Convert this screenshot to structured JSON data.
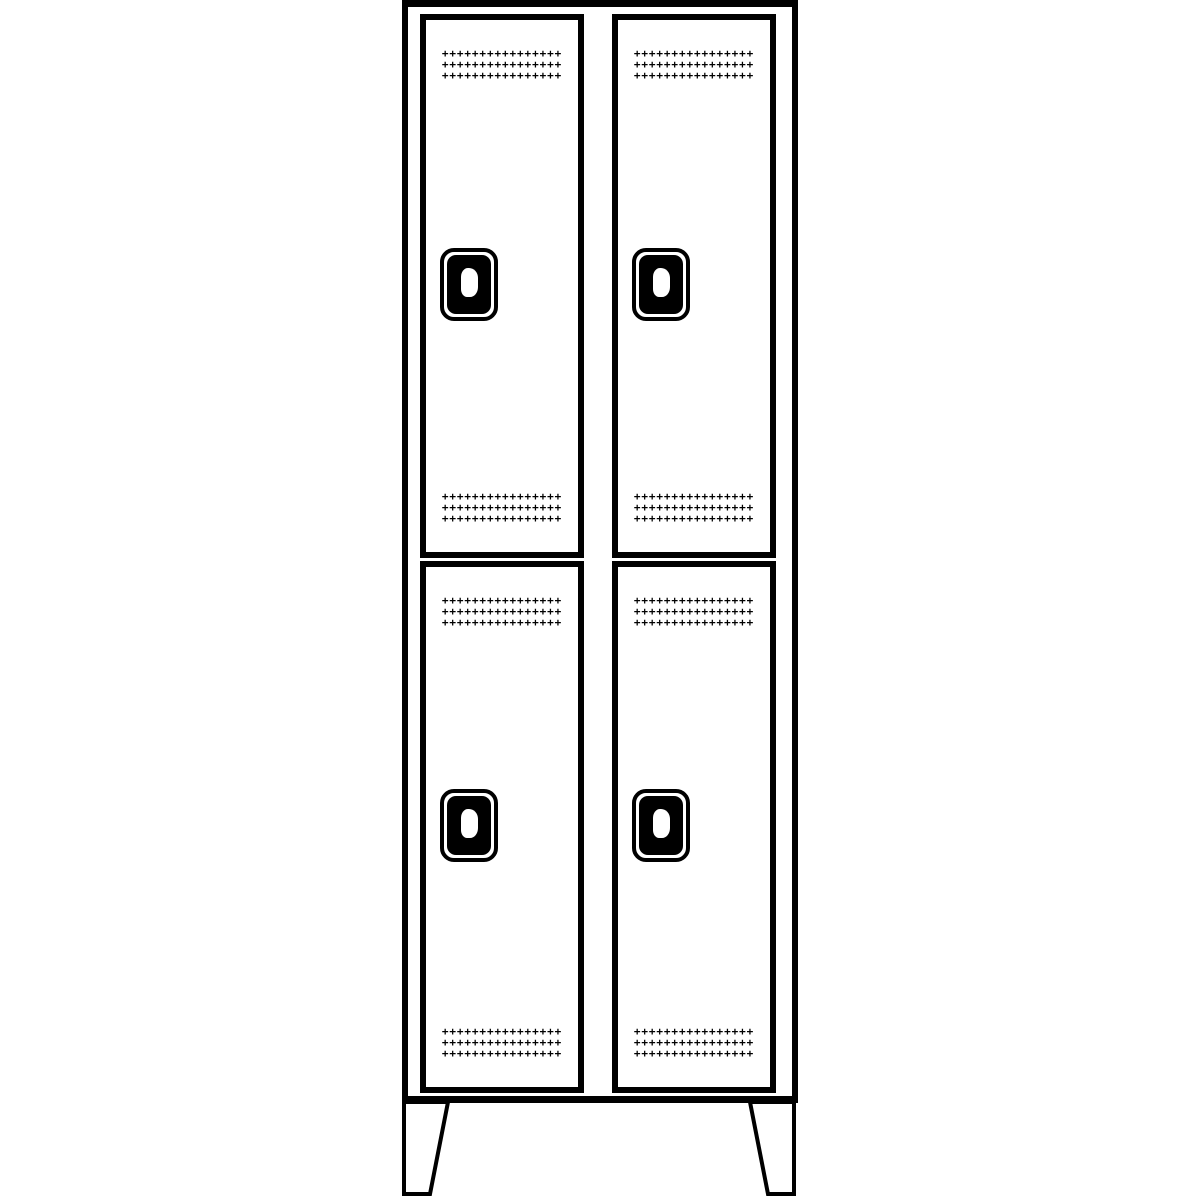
{
  "page": {
    "background_color": "#ffffff",
    "drawing_color": "#000000"
  },
  "locker": {
    "columns": 2,
    "tiers": 2,
    "door_count": 4,
    "feet_count": 2,
    "vents_per_door": 2,
    "vent_rows": 3,
    "vent_columns": 16,
    "vent_block": "++++++++++++++++\n++++++++++++++++\n++++++++++++++++"
  }
}
